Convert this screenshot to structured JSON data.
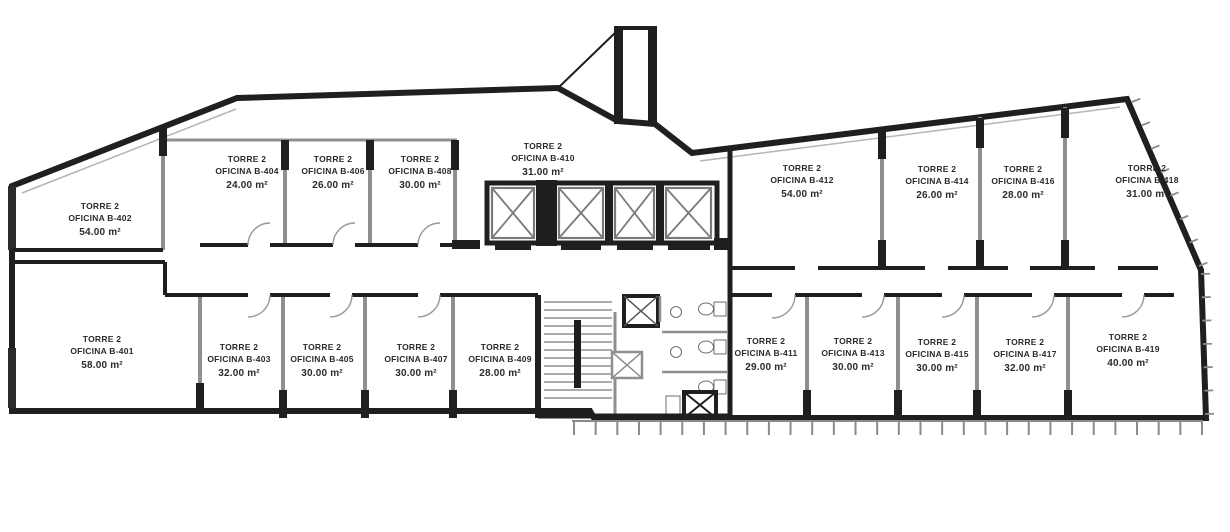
{
  "plan": {
    "tower_label": "TORRE 2",
    "rooms": {
      "b402": {
        "unit": "OFICINA B-402",
        "area": "54.00 m²"
      },
      "b404": {
        "unit": "OFICINA B-404",
        "area": "24.00 m²"
      },
      "b406": {
        "unit": "OFICINA B-406",
        "area": "26.00 m²"
      },
      "b408": {
        "unit": "OFICINA B-408",
        "area": "30.00 m²"
      },
      "b410": {
        "unit": "OFICINA B-410",
        "area": "31.00 m²"
      },
      "b412": {
        "unit": "OFICINA B-412",
        "area": "54.00 m²"
      },
      "b414": {
        "unit": "OFICINA B-414",
        "area": "26.00 m²"
      },
      "b416": {
        "unit": "OFICINA B-416",
        "area": "28.00 m²"
      },
      "b418": {
        "unit": "OFICINA B-418",
        "area": "31.00 m²"
      },
      "b401": {
        "unit": "OFICINA B-401",
        "area": "58.00 m²"
      },
      "b403": {
        "unit": "OFICINA B-403",
        "area": "32.00 m²"
      },
      "b405": {
        "unit": "OFICINA B-405",
        "area": "30.00 m²"
      },
      "b407": {
        "unit": "OFICINA B-407",
        "area": "30.00 m²"
      },
      "b409": {
        "unit": "OFICINA B-409",
        "area": "28.00 m²"
      },
      "b411": {
        "unit": "OFICINA B-411",
        "area": "29.00 m²"
      },
      "b413": {
        "unit": "OFICINA B-413",
        "area": "30.00 m²"
      },
      "b415": {
        "unit": "OFICINA B-415",
        "area": "30.00 m²"
      },
      "b417": {
        "unit": "OFICINA B-417",
        "area": "32.00 m²"
      },
      "b419": {
        "unit": "OFICINA B-419",
        "area": "40.00 m²"
      }
    },
    "colors": {
      "wall_dark": "#1f1f1f",
      "wall_gray": "#8f8f8f",
      "text": "#2b2b2b",
      "background": "#ffffff"
    }
  }
}
